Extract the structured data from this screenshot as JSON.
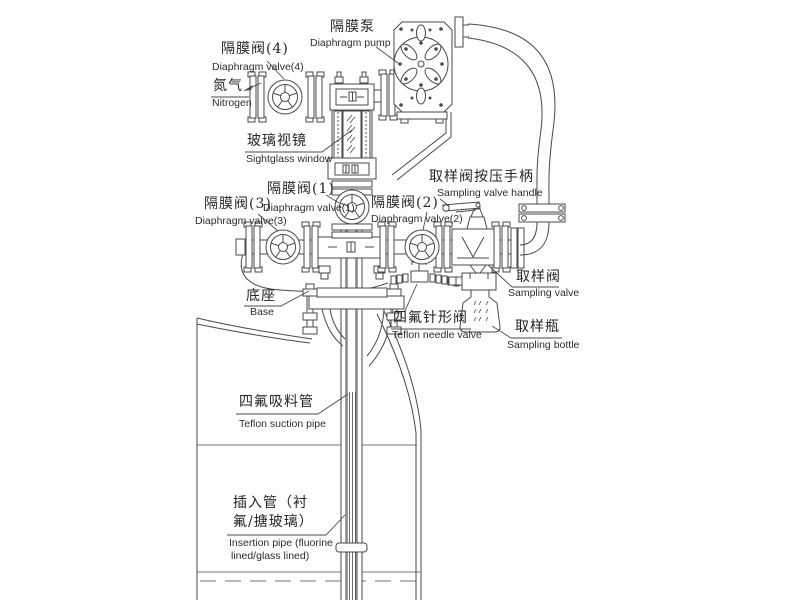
{
  "diagram": {
    "background_color": "#ffffff",
    "line_color": "#4a4a4a",
    "pipe_fill_color": "#8a8a8a",
    "labels": {
      "pump": {
        "zh": "隔膜泵",
        "en": "Diaphragm pump"
      },
      "valve4": {
        "zh": "隔膜阀(4)",
        "en": "Diaphragm valve(4)"
      },
      "nitrogen": {
        "zh": "氮气",
        "en": "Nitrogen"
      },
      "sightglass": {
        "zh": "玻璃视镜",
        "en": "Sightglass window"
      },
      "valve1": {
        "zh": "隔膜阀(1)",
        "en": "Diaphragm valve(1)"
      },
      "valve3": {
        "zh": "隔膜阀(3)",
        "en": "Diaphragm valve(3)"
      },
      "valve2": {
        "zh": "隔膜阀(2)",
        "en": "Diaphragm valve(2)"
      },
      "handle": {
        "zh": "取样阀按压手柄",
        "en": "Sampling valve handle"
      },
      "sampling_valve": {
        "zh": "取样阀",
        "en": "Sampling valve"
      },
      "base": {
        "zh": "底座",
        "en": "Base"
      },
      "needle_valve": {
        "zh": "四氟针形阀",
        "en": "Teflon needle valve"
      },
      "bottle": {
        "zh": "取样瓶",
        "en": "Sampling bottle"
      },
      "suction_pipe": {
        "zh": "四氟吸料管",
        "en": "Teflon suction pipe"
      },
      "insertion_pipe": {
        "zh_line1": "插入管（衬",
        "zh_line2": "氟/搪玻璃）",
        "en_line1": "Insertion pipe (fluorine",
        "en_line2": "lined/glass lined)"
      }
    }
  }
}
